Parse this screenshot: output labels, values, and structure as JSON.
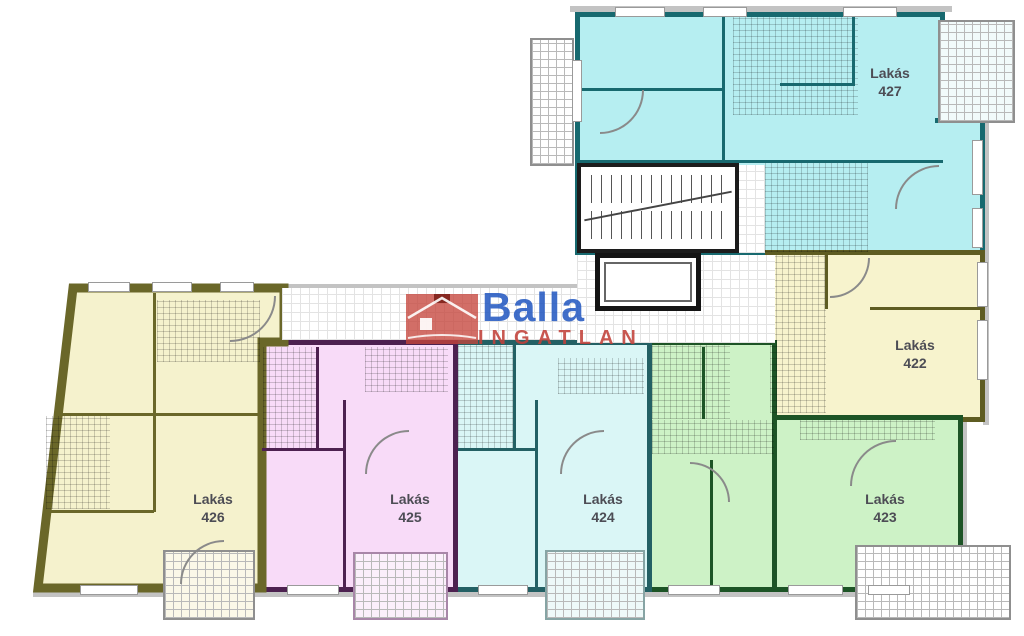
{
  "logo": {
    "brand": "Balla",
    "subtitle": "INGATLAN",
    "brand_color": "#1f55c0",
    "subtitle_color": "#c2413a",
    "house_color": "#c5453c"
  },
  "apartments": {
    "a427": {
      "name": "Lakás",
      "number": "427",
      "fill": "#b6eef1",
      "wall": "#17696f"
    },
    "a422": {
      "name": "Lakás",
      "number": "422",
      "fill": "#f7f3cd",
      "wall": "#5e5c22"
    },
    "a423": {
      "name": "Lakás",
      "number": "423",
      "fill": "#cdf2c6",
      "wall": "#1d5426"
    },
    "a424": {
      "name": "Lakás",
      "number": "424",
      "fill": "#daf6f6",
      "wall": "#236064"
    },
    "a425": {
      "name": "Lakás",
      "number": "425",
      "fill": "#f8dbf8",
      "wall": "#4d2150"
    },
    "a426": {
      "name": "Lakás",
      "number": "426",
      "fill": "#f5f2cd",
      "wall": "#6a6729"
    }
  }
}
